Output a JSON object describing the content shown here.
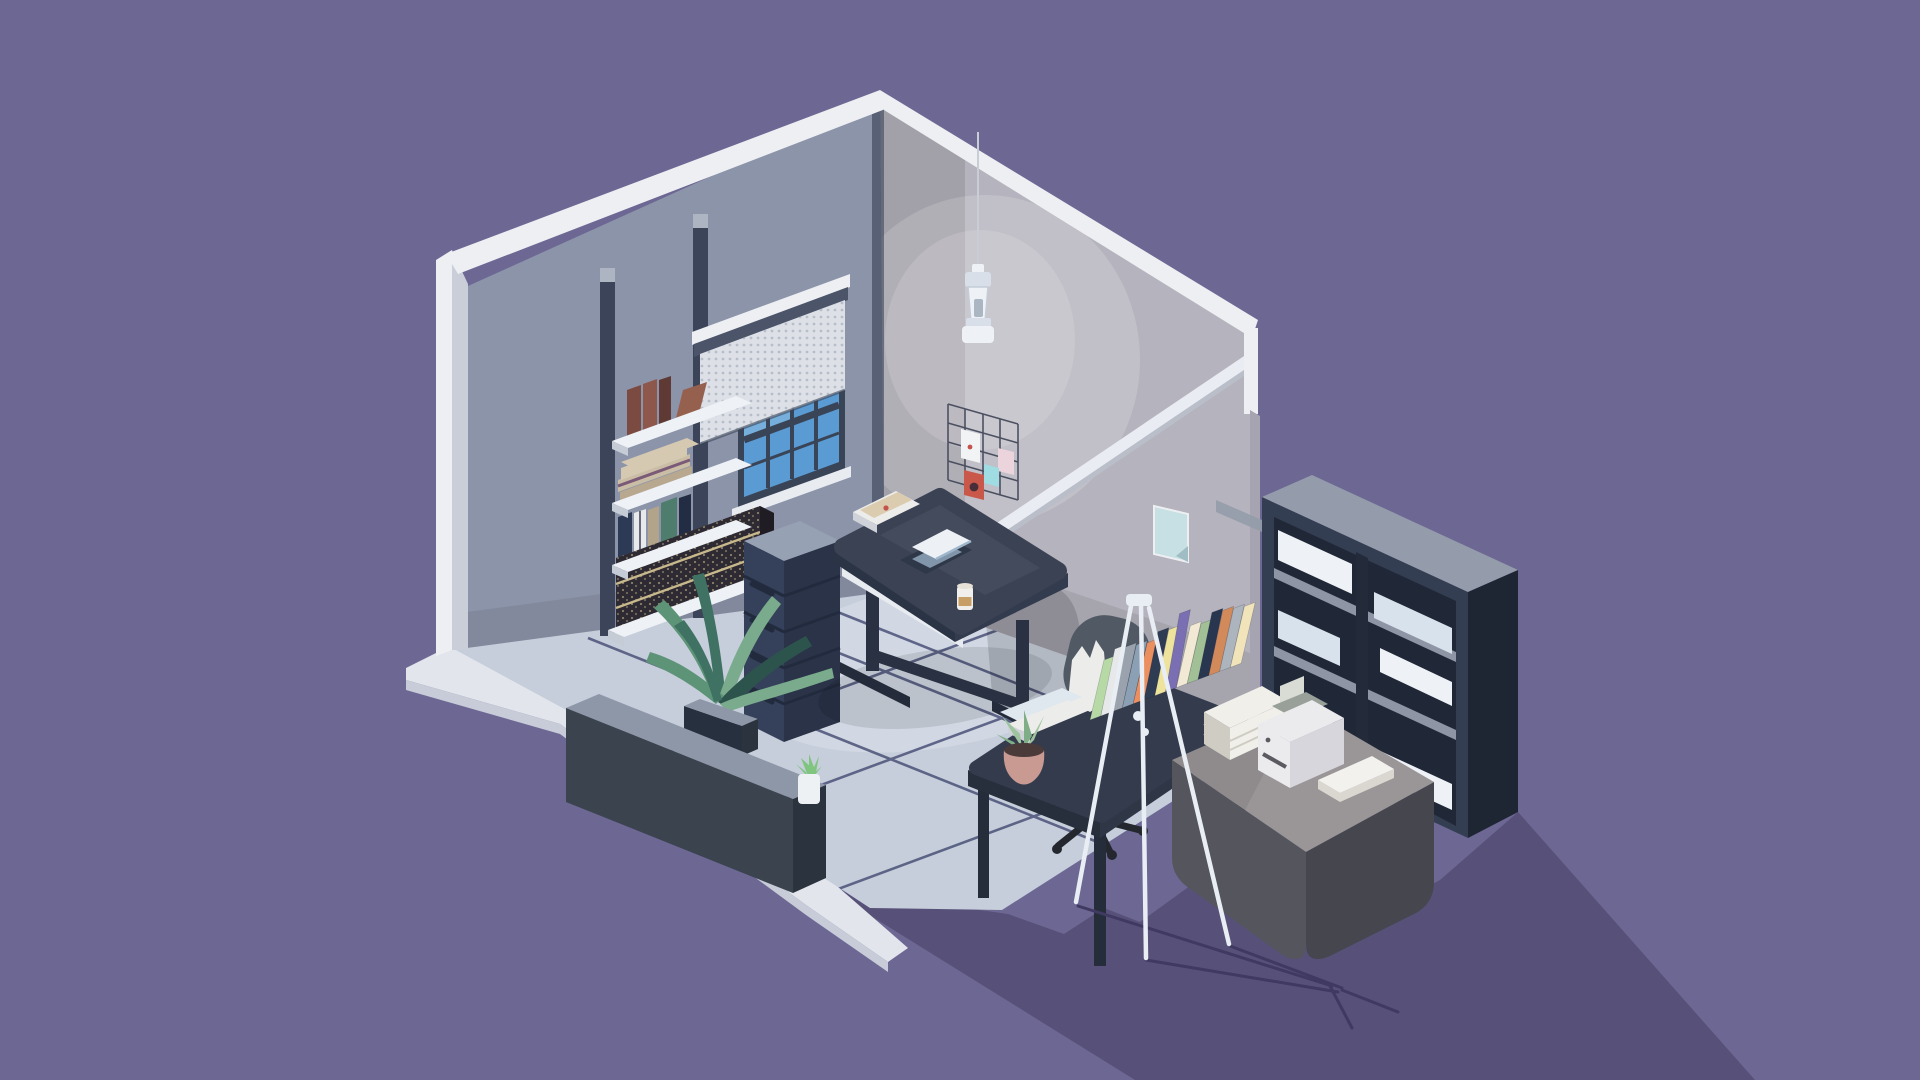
{
  "scene": {
    "title": "Isometric low-poly home office in a cutaway room",
    "style": "voxel / low-poly 3D illustration",
    "objects": [
      "cutaway room with two walls",
      "sash window with dotted roller blind",
      "wall shelves with books",
      "encyclopedia book row",
      "chest of drawers",
      "standing desk with laptop, papers and latte glass",
      "office chair",
      "pendant lamp",
      "wire memo grid with pinned cards",
      "small poster on right wall",
      "white wall rail",
      "low partition wall with succulent pot",
      "palm plant in box planter",
      "side desk with leaning book row and plant pot",
      "tripod floor lamp",
      "printer table with paper ream, printer and white book",
      "tall bookcase with white panels",
      "tiled floor with grout lines",
      "white plinth",
      "cast shadows on purple ground"
    ]
  },
  "palette": {
    "background": "#6D6794",
    "bg_shadow": "#575179",
    "tripod_shadow": "#403A63",
    "plinth_top": "#E2E6EC",
    "plinth_side": "#C7CCD8",
    "floor": "#C6CEDB",
    "grout": "#4A5278",
    "wall_left": "#8C94A9",
    "pillar": "#3B4458",
    "pillar_cap": "#AEB5C2",
    "trim": "#EDEFF3",
    "trim_shade": "#C9CED9",
    "edge_right": "#A6A4B0",
    "wall_right": "#B5B3BD",
    "rail": "#E9ECF2",
    "rail_shade": "#B9BEC9",
    "window_frame": "#3A4457",
    "window_pane": "#5B9BD4",
    "window_pane_light": "#82B7E0",
    "window_sill": "#E8ECF1",
    "valance": "#4B5468",
    "blind": "#DDE1E7",
    "blind_dot": "#B7BEC9",
    "shelf": "#EEF1F5",
    "shelf_under": "#C6CCD6",
    "dresser_front": "#35415A",
    "dresser_side": "#2A3348",
    "dresser_top": "#97A1B4",
    "dresser_seam": "#222B3E",
    "desk_top": "#3A4254",
    "desk_side": "#2B3445",
    "desk_side2": "#323C4E",
    "desk_leg": "#2A3142",
    "desk_foot": "#242B3A",
    "desk_strip": "#E8ECF1",
    "laptop_lid": "#EDF1F6",
    "laptop_base": "#2E3849",
    "laptop_screen": "#8FA6BC",
    "paper": "#ECECEA",
    "paper_tan": "#D9C9A8",
    "paper_edge": "#CFD2D8",
    "red_accent": "#C4534E",
    "glass": "#F0EFEB",
    "coffee": "#C79E66",
    "chair_back": "#515A64",
    "chair_seat": "#4A525C",
    "chair_base": "#24282E",
    "pendant": "#EEF2F7",
    "pendant_shade": "#D8DFE8",
    "pendant_core": "#AAB6C2",
    "grid_line": "#454B5C",
    "card_white": "#F2F3F4",
    "card_pink": "#ECD4DD",
    "card_cyan": "#9FDDE2",
    "card_red": "#C9584A",
    "card_red_dark": "#472E38",
    "poster": "#C6E0E4",
    "low_wall_front": "#3B434F",
    "low_wall_side": "#2B333F",
    "low_wall_top": "#8E97A8",
    "planter": "#27303F",
    "palm1": "#3F7263",
    "palm2": "#5D9478",
    "palm3": "#79AB8C",
    "palm4": "#2D544C",
    "pot_white": "#EEF1F4",
    "succulent": "#7FC47F",
    "sdesk_top": "#333B4D",
    "sdesk_edge": "#272E3C",
    "sdesk_edge2": "#2F3747",
    "sdesk_leg": "#262D3A",
    "desk_plant_pot": "#C99A92",
    "desk_plant_leaf": "#9DC49E",
    "desk_plant_leaf2": "#7FAE86",
    "soil": "#4A3A3A",
    "book_lightblue": "#DFE7EF",
    "tripod": "#E8EEF4",
    "table_top": "#8F8A8C",
    "table_front": "#54555D",
    "table_side": "#45464E",
    "ream": "#F1EFE9",
    "ream_shade": "#CFCCC4",
    "printer_body": "#EBEBEE",
    "printer_side": "#D6D6DC",
    "printer_top": "#98A099",
    "printer_paper": "#D8DCD4",
    "printer_dark": "#5A5A60",
    "book_white": "#F2F1EE",
    "book_white_side": "#D9D7CF",
    "case_front": "#333E52",
    "case_side": "#232B3A",
    "case_right": "#1E2533",
    "case_top": "#949CAB",
    "case_cavity": "#202837",
    "case_shelf": "#8E96A5",
    "case_panel": "#EEF1F6",
    "case_panel2": "#D8E2EC",
    "case_box": "#8A93A2",
    "ency_front": "#2E2A33",
    "ency_top": "#6B6258",
    "ency_line": "#C8B98C",
    "ency_side": "#1F1C24",
    "book_brown1": "#7B4A41",
    "book_brown2": "#8D574C",
    "book_brown3": "#5F3A35",
    "book_brown4": "#96604F",
    "tan1": "#D6C9B2",
    "tan2": "#CABDA6",
    "tan3": "#B7A88F",
    "tan_band": "#7B5A77",
    "vbook1": "#2C3A56",
    "vbook2": "#E7E9EC",
    "vbook3": "#B2A38B",
    "vbook4": "#4E7D6E",
    "vbook5": "#222C42",
    "floor_glow": "#DAE0EA"
  },
  "books": {
    "desk_row": [
      "#B7D9A6",
      "#E6E8EA",
      "#9AA3AD",
      "#8BA0B4",
      "#E98F60",
      "#2D3B53",
      "#EEE39C",
      "#7A6FB2",
      "#F1E9D4",
      "#A2C096",
      "#293650",
      "#D28A5B",
      "#ACB4BE",
      "#F1E4BB"
    ]
  }
}
